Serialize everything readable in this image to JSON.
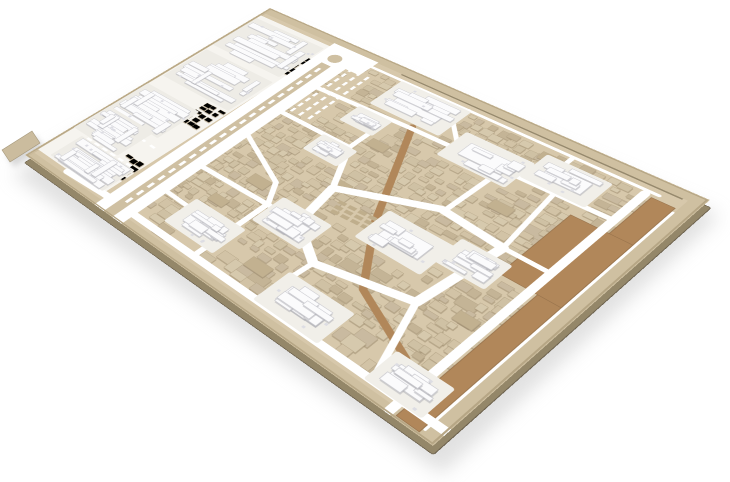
{
  "scene": {
    "alt_text": "Aerial 3D render of a tan urban massing model board tilted in perspective, with dense tan building fabric, white roads, a wide central boulevard with dashed markings, white highlighted building complexes and brown accent roads, casting a soft shadow on a white background",
    "background": "#ffffff",
    "shadow_color": "#c9c9c9",
    "board": {
      "plan_size": [
        640,
        480
      ],
      "corners": {
        "top": [
          270,
          8
        ],
        "right": [
          710,
          200
        ],
        "bottom": [
          433,
          446
        ],
        "left": [
          25,
          155
        ]
      },
      "side_offset": 7,
      "top_color": "#d7c8ab",
      "side_color": "#948769",
      "side_edge_color": "#6f6450",
      "rim_color": "#cfc0a1",
      "left_rim_color": "#cbbb9b",
      "sliver_points": [
        [
          2,
          150
        ],
        [
          32,
          131
        ],
        [
          40,
          143
        ],
        [
          10,
          162
        ]
      ],
      "shadow_points": [
        [
          270,
          26
        ],
        [
          720,
          216
        ],
        [
          442,
          474
        ],
        [
          12,
          174
        ]
      ]
    },
    "palette": {
      "fabric": [
        "#cfc1a4",
        "#d6c9ad",
        "#c9baa0",
        "#d2c3a6",
        "#c4b496"
      ],
      "fabric_shadow": "#99876b",
      "fabric_stroke": "#b2a284",
      "large_block": "#c2b190",
      "road": "#ffffff",
      "plaza": "#f6f4ef",
      "cluster_ground": "#f1efe9",
      "mega_ground": "#eeece6",
      "building_white": "#fbfbfc",
      "building_stroke": "#c6c6cc",
      "building_shadow": "#a9a9b0",
      "roof_detail": "#dddde3",
      "brown": "#b1875a",
      "brown_edge": "#96714a",
      "median": "#cfc0a2",
      "dark_line": "#8c7f63",
      "stall": "#bfae8c"
    },
    "left_district": {
      "bounds": [
        4,
        24,
        134,
        436
      ],
      "complexes": [
        {
          "center": [
            68,
            80
          ],
          "size": [
            120,
            85
          ]
        },
        {
          "center": [
            70,
            185
          ],
          "size": [
            120,
            80
          ]
        },
        {
          "center": [
            55,
            295
          ],
          "size": [
            95,
            70
          ]
        },
        {
          "center": [
            48,
            362
          ],
          "size": [
            85,
            58
          ]
        },
        {
          "center": [
            80,
            428
          ],
          "size": [
            100,
            48
          ]
        }
      ],
      "patches": [
        [
          102,
          64,
          30,
          48
        ],
        [
          98,
          232,
          34,
          52
        ],
        [
          100,
          382,
          32,
          44
        ]
      ],
      "stall_rows": [
        {
          "from": [
            40,
            398
          ],
          "to": [
            120,
            398
          ],
          "step": 15,
          "w": 9,
          "h": 4
        },
        {
          "from": [
            36,
            346
          ],
          "to": [
            115,
            351
          ],
          "step": 16,
          "w": 9,
          "h": 4
        }
      ]
    },
    "boulevard": {
      "band": [
        [
          134,
          14
        ],
        [
          186,
          14
        ],
        [
          198,
          480
        ],
        [
          146,
          480
        ]
      ],
      "median": [
        [
          152,
          62
        ],
        [
          168,
          62
        ],
        [
          180,
          480
        ],
        [
          164,
          480
        ]
      ],
      "plaza_patch": [
        140,
        14,
        70,
        40
      ],
      "turnaround": {
        "cx": 160,
        "cy": 44,
        "r_outer": 22,
        "r_island": 10
      },
      "median_dashes": {
        "from": [
          160,
          80
        ],
        "to": [
          172,
          444
        ],
        "step": 19,
        "w": 11,
        "h": 4.5
      },
      "side_dash_columns": [
        {
          "from": [
            194,
            52
          ],
          "to": [
            196,
            170
          ],
          "step": 14,
          "w": 9,
          "h": 4
        },
        {
          "from": [
            208,
            52
          ],
          "to": [
            210,
            170
          ],
          "step": 14,
          "w": 9,
          "h": 4
        },
        {
          "from": [
            222,
            54
          ],
          "to": [
            224,
            168
          ],
          "step": 14,
          "w": 9,
          "h": 4
        }
      ]
    },
    "fabric_zone": {
      "x0": 186,
      "x1": 594,
      "y0": 34,
      "y1": 452,
      "row_step": 14,
      "col_step": 15,
      "exclusions": [
        [
          186,
          40,
          44,
          135
        ],
        [
          354,
          258,
          88,
          42
        ]
      ]
    },
    "roads": [
      {
        "points": [
          [
            70,
            462
          ],
          [
            140,
            458
          ],
          [
            640,
            458
          ]
        ],
        "width": 11
      },
      {
        "points": [
          [
            588,
            34
          ],
          [
            588,
            476
          ]
        ],
        "width": 10
      },
      {
        "points": [
          [
            190,
            28
          ],
          [
            600,
            28
          ]
        ],
        "width": 5
      },
      {
        "points": [
          [
            186,
            112
          ],
          [
            330,
            104
          ],
          [
            588,
            96
          ]
        ],
        "width": 8
      },
      {
        "points": [
          [
            186,
            184
          ],
          [
            300,
            184
          ],
          [
            336,
            258
          ]
        ],
        "width": 8
      },
      {
        "points": [
          [
            300,
            108
          ],
          [
            300,
            186
          ]
        ],
        "width": 7
      },
      {
        "points": [
          [
            300,
            332
          ],
          [
            300,
            456
          ]
        ],
        "width": 8
      },
      {
        "points": [
          [
            452,
            204
          ],
          [
            456,
            100
          ]
        ],
        "width": 7
      },
      {
        "points": [
          [
            532,
            212
          ],
          [
            588,
            212
          ]
        ],
        "width": 7
      },
      {
        "points": [
          [
            518,
            342
          ],
          [
            552,
            452
          ]
        ],
        "width": 8
      },
      {
        "points": [
          [
            404,
            372
          ],
          [
            398,
            454
          ]
        ],
        "width": 7
      },
      {
        "points": [
          [
            348,
            332
          ],
          [
            186,
            336
          ]
        ],
        "width": 8
      },
      {
        "points": [
          [
            360,
            28
          ],
          [
            360,
            60
          ],
          [
            400,
            104
          ]
        ],
        "width": 6
      },
      {
        "points": [
          [
            500,
            30
          ],
          [
            500,
            96
          ]
        ],
        "width": 6
      },
      {
        "points": [
          [
            520,
            98
          ],
          [
            532,
            212
          ]
        ],
        "width": 6
      },
      {
        "points": [
          [
            186,
            248
          ],
          [
            280,
            296
          ],
          [
            300,
            332
          ]
        ],
        "width": 7
      },
      {
        "points": [
          [
            186,
            400
          ],
          [
            300,
            404
          ]
        ],
        "width": 7
      },
      {
        "points": [
          [
            624,
            44
          ],
          [
            624,
            470
          ]
        ],
        "width": 3
      }
    ],
    "ring_road": {
      "points": [
        [
          336,
          258
        ],
        [
          448,
          204
        ],
        [
          532,
          212
        ],
        [
          518,
          342
        ],
        [
          404,
          372
        ],
        [
          348,
          332
        ]
      ],
      "width": 12
    },
    "brown_routes": {
      "band": {
        "x": 596,
        "width": 26,
        "y0": 36,
        "y1": 476
      },
      "bulge": [
        552,
        118,
        70,
        130
      ],
      "central": {
        "points": [
          [
            330,
            100
          ],
          [
            410,
            274
          ],
          [
            468,
            366
          ],
          [
            558,
            412
          ]
        ],
        "width": 9
      }
    },
    "container_rows": [
      {
        "from": [
          362,
          272
        ],
        "to": [
          430,
          266
        ],
        "step": 13,
        "w": 10,
        "h": 6
      },
      {
        "from": [
          364,
          281
        ],
        "to": [
          432,
          275
        ],
        "step": 13,
        "w": 10,
        "h": 6
      },
      {
        "from": [
          366,
          290
        ],
        "to": [
          434,
          284
        ],
        "step": 13,
        "w": 10,
        "h": 6
      }
    ],
    "white_clusters": [
      {
        "center": [
          312,
          62
        ],
        "size": [
          95,
          56
        ]
      },
      {
        "center": [
          280,
          128
        ],
        "size": [
          42,
          30
        ]
      },
      {
        "center": [
          286,
          204
        ],
        "size": [
          44,
          30
        ]
      },
      {
        "center": [
          430,
          96
        ],
        "size": [
          82,
          50
        ]
      },
      {
        "center": [
          516,
          70
        ],
        "size": [
          70,
          46
        ]
      },
      {
        "center": [
          452,
          276
        ],
        "size": [
          78,
          52
        ]
      },
      {
        "center": [
          524,
          254
        ],
        "size": [
          52,
          40
        ]
      },
      {
        "center": [
          342,
          338
        ],
        "size": [
          64,
          46
        ]
      },
      {
        "center": [
          272,
          412
        ],
        "size": [
          72,
          46
        ]
      },
      {
        "center": [
          440,
          430
        ],
        "size": [
          80,
          50
        ]
      },
      {
        "center": [
          580,
          436
        ],
        "size": [
          58,
          42
        ]
      }
    ],
    "large_blocks": [
      [
        310,
        150,
        26,
        16
      ],
      [
        250,
        300,
        28,
        18
      ],
      [
        350,
        410,
        30,
        18
      ],
      [
        480,
        150,
        26,
        16
      ],
      [
        556,
        320,
        24,
        16
      ],
      [
        330,
        240,
        22,
        14
      ],
      [
        470,
        40,
        24,
        15
      ],
      [
        240,
        360,
        24,
        15
      ]
    ],
    "accents": {
      "top_rim": [
        0,
        0,
        640,
        16
      ],
      "bottom_rim": [
        0,
        468,
        640,
        12
      ],
      "left_rim": [
        0,
        0,
        6,
        480
      ],
      "right_rim": [
        625,
        0,
        15,
        480
      ],
      "top_line": [
        250,
        16,
        370,
        2.5
      ]
    }
  }
}
